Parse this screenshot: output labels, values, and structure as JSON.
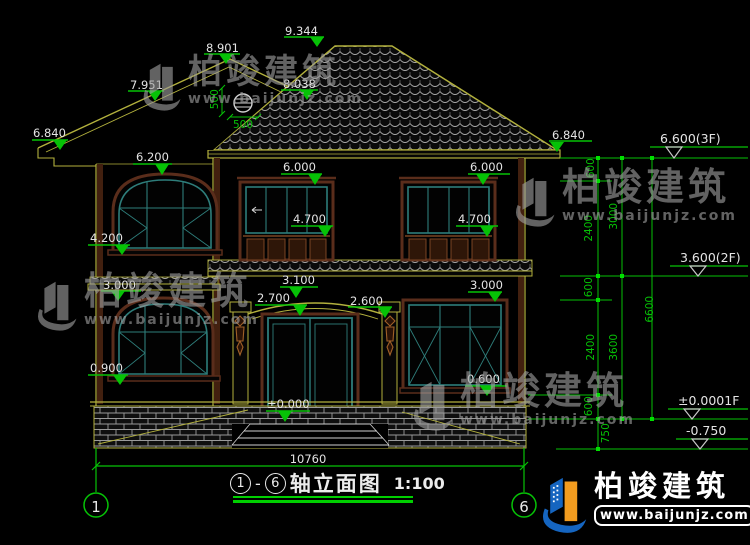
{
  "drawing": {
    "title": {
      "bubble_left": "1",
      "dash": "-",
      "bubble_right": "6",
      "name": "轴立面图",
      "scale": "1:100"
    },
    "axis": {
      "left": "1",
      "right": "6"
    },
    "markers": {
      "m9344": "9.344",
      "m8901": "8.901",
      "m7951": "7.951",
      "m8038": "8.038",
      "m6840l": "6.840",
      "m6840r": "6.840",
      "m6200": "6.200",
      "m6000l": "6.000",
      "m6000r": "6.000",
      "m4700l": "4.700",
      "m4700r": "4.700",
      "m4200": "4.200",
      "m3000l": "3.000",
      "m3100": "3.100",
      "m2700": "2.700",
      "m2600": "2.600",
      "m3000r": "3.000",
      "m0900": "0.900",
      "m0000": "±0.000",
      "m0600": "0.600"
    },
    "datums": {
      "f3": "6.600(3F)",
      "f2": "3.600(2F)",
      "f1": "±0.0001F",
      "ground": "-0.750"
    },
    "dims": {
      "chain_a": [
        "600",
        "2400",
        "600",
        "2400",
        "600",
        "750"
      ],
      "chain_b": [
        "3000",
        "3600"
      ],
      "chain_c": [
        "6600"
      ],
      "bottom_width": "10760",
      "ornament_v": "500",
      "ornament_h": "500"
    },
    "watermark": {
      "brand": "柏竣建筑",
      "url": "www.baijunjz.com"
    },
    "footer": {
      "brand": "柏竣建筑",
      "url": "www.baijunjz.com"
    }
  },
  "colors": {
    "line_yellow": "#b3b13d",
    "dim_green": "#06c206",
    "frame_teal": "#2e7d7a",
    "frame_brown": "#5a2d1b",
    "logo_blue": "#1565c0",
    "logo_orange": "#f29c1f"
  }
}
